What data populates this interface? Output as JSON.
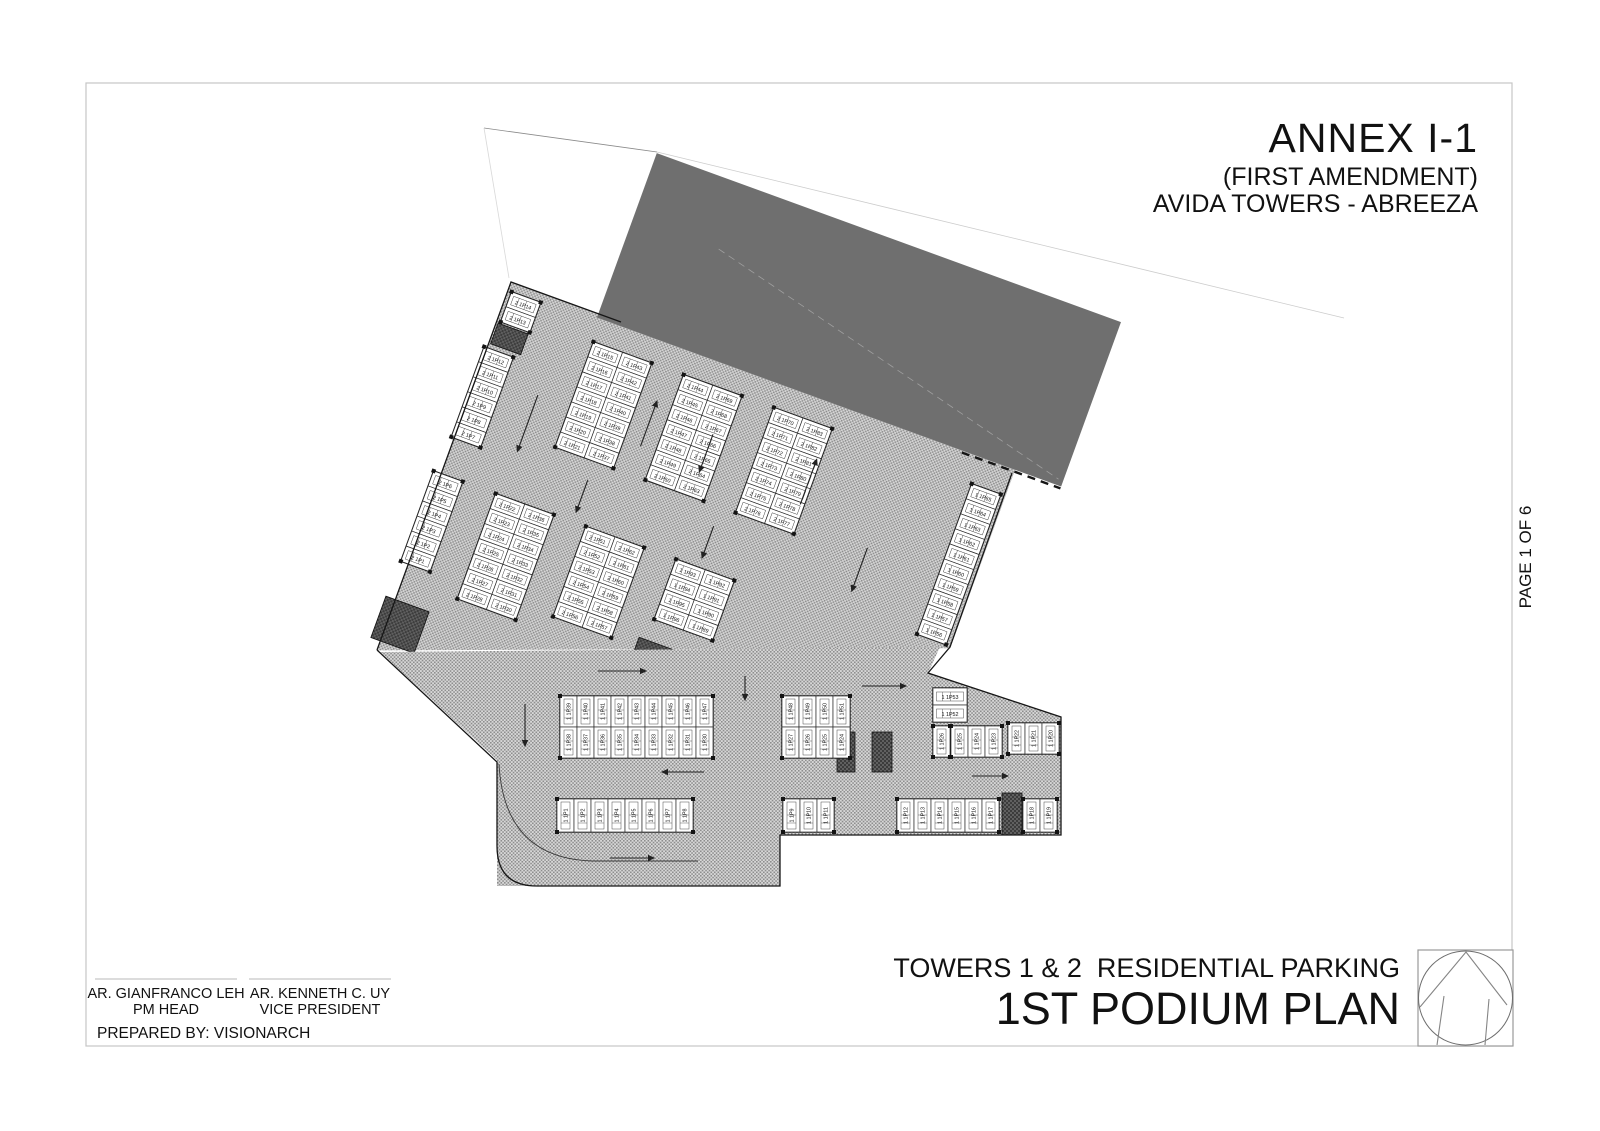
{
  "header": {
    "annex": "ANNEX I-1",
    "amendment": "(FIRST AMENDMENT)",
    "project": "AVIDA TOWERS - ABREEZA"
  },
  "side": {
    "page_label": "PAGE 1 OF 6"
  },
  "footer": {
    "title_line1": "TOWERS 1 & 2  RESIDENTIAL PARKING",
    "title_line2": "1ST PODIUM PLAN",
    "prepared_by": "PREPARED BY: VISIONARCH",
    "signatories": [
      {
        "name": "AR. GIANFRANCO LEH",
        "role": "PM HEAD"
      },
      {
        "name": "AR. KENNETH C. UY",
        "role": "VICE PRESIDENT"
      }
    ]
  },
  "colors": {
    "building_gray": "#6f6f6f",
    "aisle_bg": "#d7d7d7",
    "aisle_dot": "#8d8d8d",
    "core_bg": "#606060",
    "core_dot": "#3c3c3c",
    "frame": "#c6c6c6",
    "line": "#161616"
  },
  "plan": {
    "stall_code": "1P",
    "rotation": 20,
    "rotation_center": [
      700,
      470
    ],
    "upper_blocks": [
      {
        "x": 462,
        "y": 367,
        "cols": [
          {
            "pre": "2",
            "from": 14,
            "to": 13
          }
        ]
      },
      {
        "x": 455,
        "y": 428,
        "cols": [
          {
            "pre": "2",
            "from": 12,
            "to": 7
          }
        ]
      },
      {
        "x": 450,
        "y": 562,
        "cols": [
          {
            "pre": "2",
            "from": 6,
            "to": 1
          }
        ]
      },
      {
        "x": 556,
        "y": 386,
        "cols": [
          {
            "pre": "2",
            "from": 15,
            "to": 21
          },
          {
            "pre": "2",
            "from": 43,
            "to": 37
          }
        ]
      },
      {
        "x": 516,
        "y": 562,
        "cols": [
          {
            "pre": "2",
            "from": 22,
            "to": 28
          },
          {
            "pre": "2",
            "from": 36,
            "to": 30
          }
        ]
      },
      {
        "x": 652,
        "y": 386,
        "cols": [
          {
            "pre": "2",
            "from": 44,
            "to": 50
          },
          {
            "pre": "2",
            "from": 69,
            "to": 63
          }
        ]
      },
      {
        "x": 612,
        "y": 562,
        "cols": [
          {
            "pre": "2",
            "from": 51,
            "to": 56
          },
          {
            "pre": "2",
            "from": 62,
            "to": 57
          }
        ]
      },
      {
        "x": 748,
        "y": 386,
        "cols": [
          {
            "pre": "2",
            "from": 70,
            "to": 76
          },
          {
            "pre": "2",
            "from": 83,
            "to": 77
          }
        ]
      },
      {
        "x": 708,
        "y": 562,
        "cols": [
          {
            "pre": "1",
            "from": 93,
            "to": 96
          },
          {
            "pre": "1",
            "from": 92,
            "to": 89
          }
        ]
      },
      {
        "x": 960,
        "y": 390,
        "cols": [
          {
            "pre": "1",
            "from": 65,
            "to": 56
          }
        ]
      }
    ],
    "lower_blocks": [
      {
        "x": 560,
        "y": 696,
        "h": 31,
        "rows": [
          {
            "pre": "1",
            "from": 39,
            "to": 47
          },
          {
            "pre": "1",
            "from": 38,
            "to": 30
          }
        ]
      },
      {
        "x": 782,
        "y": 696,
        "h": 31,
        "rows": [
          {
            "pre": "1",
            "from": 48,
            "to": 51
          },
          {
            "pre": "1",
            "from": 27,
            "to": 24
          }
        ]
      },
      {
        "x": 933,
        "y": 726,
        "h": 31,
        "rows": [
          {
            "pre": "1",
            "from": 26,
            "to": 26
          }
        ]
      },
      {
        "x": 951,
        "y": 726,
        "h": 31,
        "rows": [
          {
            "pre": "1",
            "from": 25,
            "to": 23
          }
        ]
      },
      {
        "x": 1008,
        "y": 723,
        "h": 31,
        "rows": [
          {
            "pre": "1",
            "from": 22,
            "to": 20
          }
        ]
      },
      {
        "x": 557,
        "y": 799,
        "h": 33,
        "rows": [
          {
            "pre": "1",
            "from": 1,
            "to": 8
          }
        ]
      },
      {
        "x": 783,
        "y": 799,
        "h": 33,
        "rows": [
          {
            "pre": "1",
            "from": 9,
            "to": 11
          }
        ]
      },
      {
        "x": 897,
        "y": 799,
        "h": 33,
        "rows": [
          {
            "pre": "1",
            "from": 12,
            "to": 17
          }
        ]
      },
      {
        "x": 1023,
        "y": 799,
        "h": 33,
        "rows": [
          {
            "pre": "1",
            "from": 18,
            "to": 19
          }
        ]
      }
    ],
    "mini_horizontal": [
      {
        "x": 933,
        "y": 688,
        "stalls": [
          {
            "pre": "1",
            "n": 53
          },
          {
            "pre": "1",
            "n": 52
          }
        ]
      }
    ],
    "cores_screen": [
      {
        "x": 837,
        "y": 732,
        "w": 18,
        "h": 40
      },
      {
        "x": 872,
        "y": 732,
        "w": 20,
        "h": 40
      },
      {
        "x": 1002,
        "y": 793,
        "w": 20,
        "h": 42
      }
    ],
    "cores_local": [
      {
        "x": 460,
        "y": 401,
        "w": 32,
        "h": 22
      },
      {
        "x": 448,
        "y": 696,
        "w": 46,
        "h": 44
      },
      {
        "x": 700,
        "y": 648,
        "w": 40,
        "h": 24
      }
    ],
    "arrows_screen": [
      [
        598,
        671,
        646,
        671
      ],
      [
        704,
        772,
        662,
        772
      ],
      [
        862,
        686,
        906,
        686
      ],
      [
        610,
        858,
        654,
        858
      ],
      [
        972,
        776,
        1008,
        776
      ],
      [
        525,
        704,
        525,
        746
      ],
      [
        745,
        676,
        745,
        700
      ]
    ],
    "arrows_local": [
      [
        522,
        455,
        522,
        515
      ],
      [
        598,
        518,
        598,
        552
      ],
      [
        636,
        468,
        636,
        420
      ],
      [
        700,
        432,
        700,
        472
      ],
      [
        732,
        518,
        732,
        552
      ],
      [
        806,
        468,
        806,
        420
      ],
      [
        884,
        486,
        884,
        532
      ]
    ]
  }
}
